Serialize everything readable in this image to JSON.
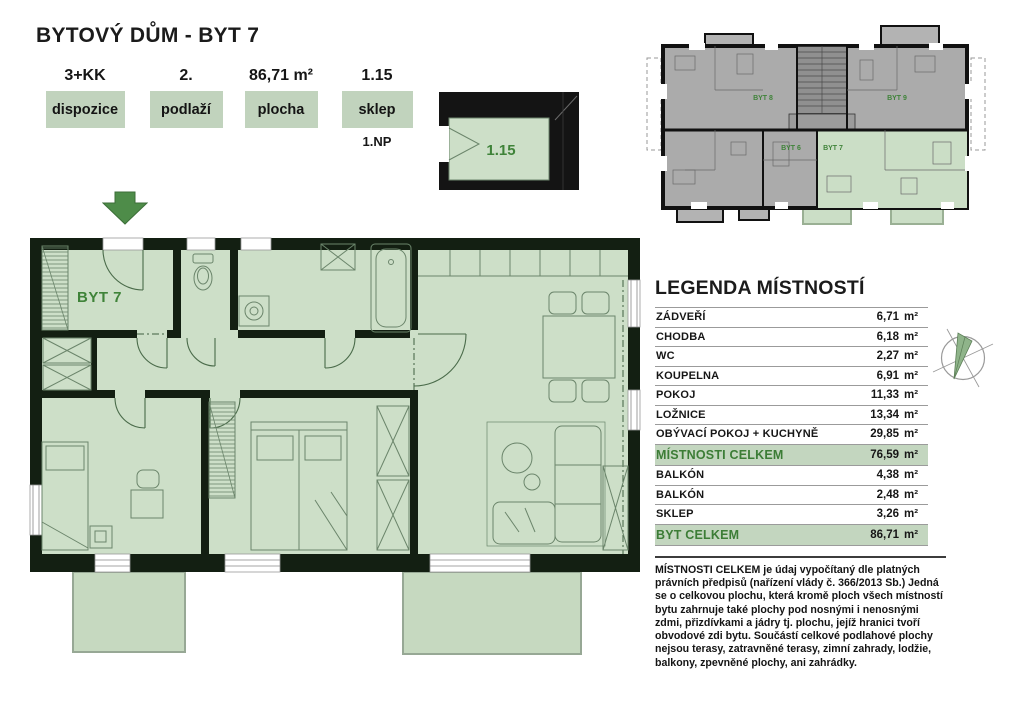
{
  "title": "BYTOVÝ DŮM - BYT 7",
  "badges": [
    {
      "value": "3+KK",
      "label": "dispozice",
      "note": ""
    },
    {
      "value": "2.",
      "label": "podlaží",
      "note": ""
    },
    {
      "value": "86,71 m²",
      "label": "plocha",
      "note": ""
    },
    {
      "value": "1.15",
      "label": "sklep",
      "note": "1.NP"
    }
  ],
  "cellar": {
    "room_number": "1.15"
  },
  "floorplan": {
    "apartment_label": "BYT 7"
  },
  "overview_labels": {
    "top_left": "BYT 8",
    "top_right": "BYT 9",
    "bottom_left": "BYT 6",
    "bottom_right": "BYT 7"
  },
  "legend": {
    "title": "LEGENDA MÍSTNOSTÍ",
    "rows": [
      {
        "label": "ZÁDVEŘÍ",
        "value": "6,71",
        "unit": "m²",
        "highlight": false
      },
      {
        "label": "CHODBA",
        "value": "6,18",
        "unit": "m²",
        "highlight": false
      },
      {
        "label": "WC",
        "value": "2,27",
        "unit": "m²",
        "highlight": false
      },
      {
        "label": "KOUPELNA",
        "value": "6,91",
        "unit": "m²",
        "highlight": false
      },
      {
        "label": "POKOJ",
        "value": "11,33",
        "unit": "m²",
        "highlight": false
      },
      {
        "label": "LOŽNICE",
        "value": "13,34",
        "unit": "m²",
        "highlight": false
      },
      {
        "label": "OBÝVACÍ POKOJ + KUCHYNĚ",
        "value": "29,85",
        "unit": "m²",
        "highlight": false
      },
      {
        "label": "MÍSTNOSTI CELKEM",
        "value": "76,59",
        "unit": "m²",
        "highlight": true
      },
      {
        "label": "BALKÓN",
        "value": "4,38",
        "unit": "m²",
        "highlight": false
      },
      {
        "label": "BALKÓN",
        "value": "2,48",
        "unit": "m²",
        "highlight": false
      },
      {
        "label": "SKLEP",
        "value": "3,26",
        "unit": "m²",
        "highlight": false
      },
      {
        "label": "BYT CELKEM",
        "value": "86,71",
        "unit": "m²",
        "highlight": true
      }
    ]
  },
  "footnote": "MÍSTNOSTI CELKEM je údaj vypočítaný dle platných právních předpisů (nařízení vlády č. 366/2013 Sb.) Jedná se o celkovou plochu, která kromě ploch všech místností bytu zahrnuje také plochy pod nosnými i nenosnými zdmi, přizdívkami a jádry tj. plochu, jejíž hranici tvoří obvodové zdi bytu. Součástí celkové podlahové plochy nejsou terasy, zatravněné terasy, zimní zahrady, lodžie, balkony, zpevněné plochy, ani zahrádky.",
  "colors": {
    "accent_green": "#3f8339",
    "badge_bg": "#c1d3bd",
    "room_fill": "#cddfc8",
    "wall_dark": "#131f12",
    "highlight_row_bg": "#c3d6bf",
    "overview_gray": "#ababab",
    "arrow_green": "#4e8c49"
  }
}
